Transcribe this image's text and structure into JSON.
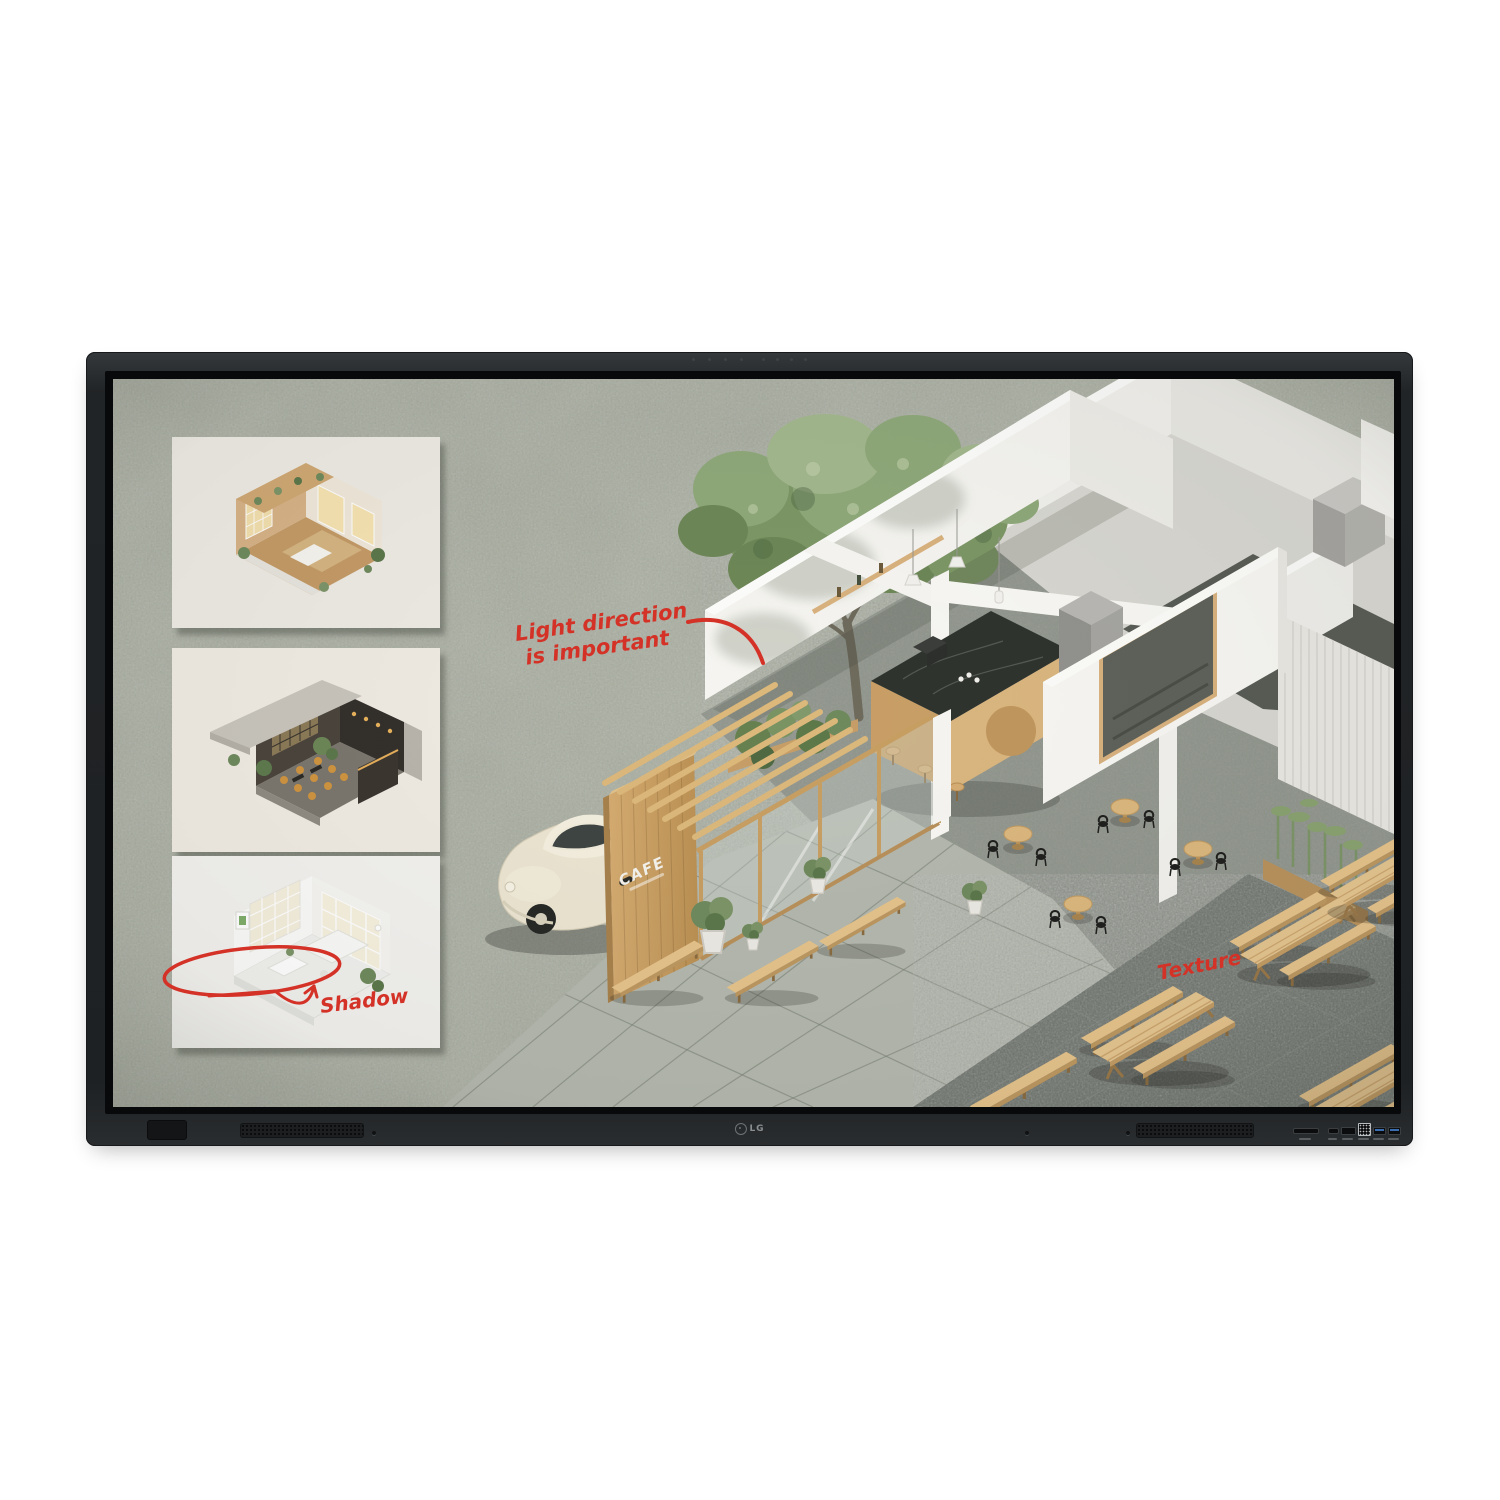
{
  "product": {
    "type": "LG interactive flat panel display – product photo",
    "brand": "LG"
  },
  "bezel": {
    "logo_text": "LG",
    "color": "#212426",
    "usb_port_color": "#3a6db0"
  },
  "screen": {
    "felt_background_color": "#abb0a2",
    "annotation_color": "#d43127",
    "annotations": {
      "light_direction_line1": "Light direction",
      "light_direction_line2": "is important",
      "shadow": "Shadow",
      "texture": "Texture"
    },
    "cafe_sign": "CAFE",
    "thumbnails": [
      {
        "id": "warm-wood-cafe-interior"
      },
      {
        "id": "dark-lounge-cafe-interior"
      },
      {
        "id": "white-minimal-cafe-interior"
      }
    ]
  }
}
